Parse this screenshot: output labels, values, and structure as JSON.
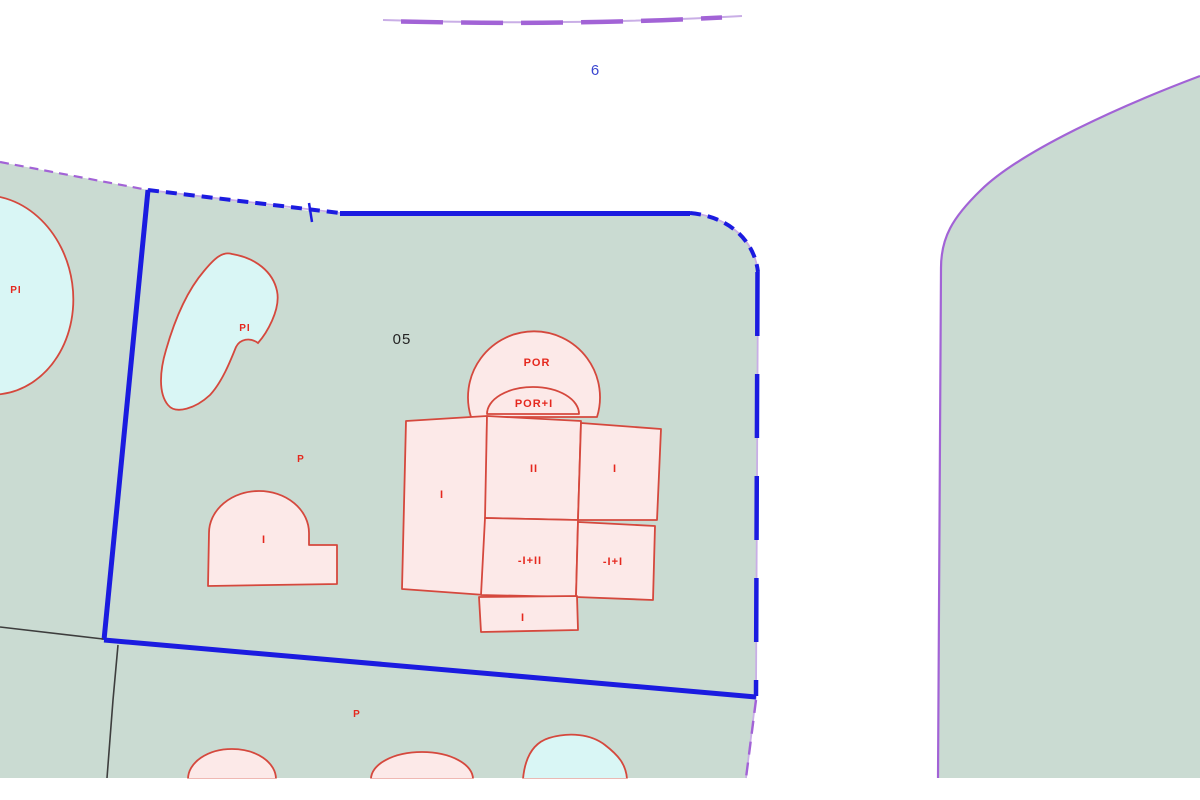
{
  "road_label": "6",
  "parcel_number": "05",
  "labels": {
    "pool_left": "PI",
    "pool_garden": "PI",
    "porch": "POR",
    "porch_plus": "POR+I",
    "wing_left": "I",
    "block_center": "II",
    "block_right": "I",
    "basement_center": "-I+II",
    "basement_right": "-I+I",
    "block_bottom": "I",
    "annex": "I",
    "patio_upper": "P",
    "patio_lower": "P"
  },
  "colors": {
    "parcel_fill": "#cadbd2",
    "pool_fill": "#d9f6f5",
    "building_fill": "#fce9e8",
    "building_stroke": "#d5483d",
    "label_red": "#e5281e",
    "boundary_blue": "#1b1be0",
    "road_purple": "#a263d6",
    "road_purple_light": "#c9aee6",
    "parcel_black": "#3d3d3d",
    "text_blue": "#3a46d0",
    "text_black": "#242424"
  }
}
